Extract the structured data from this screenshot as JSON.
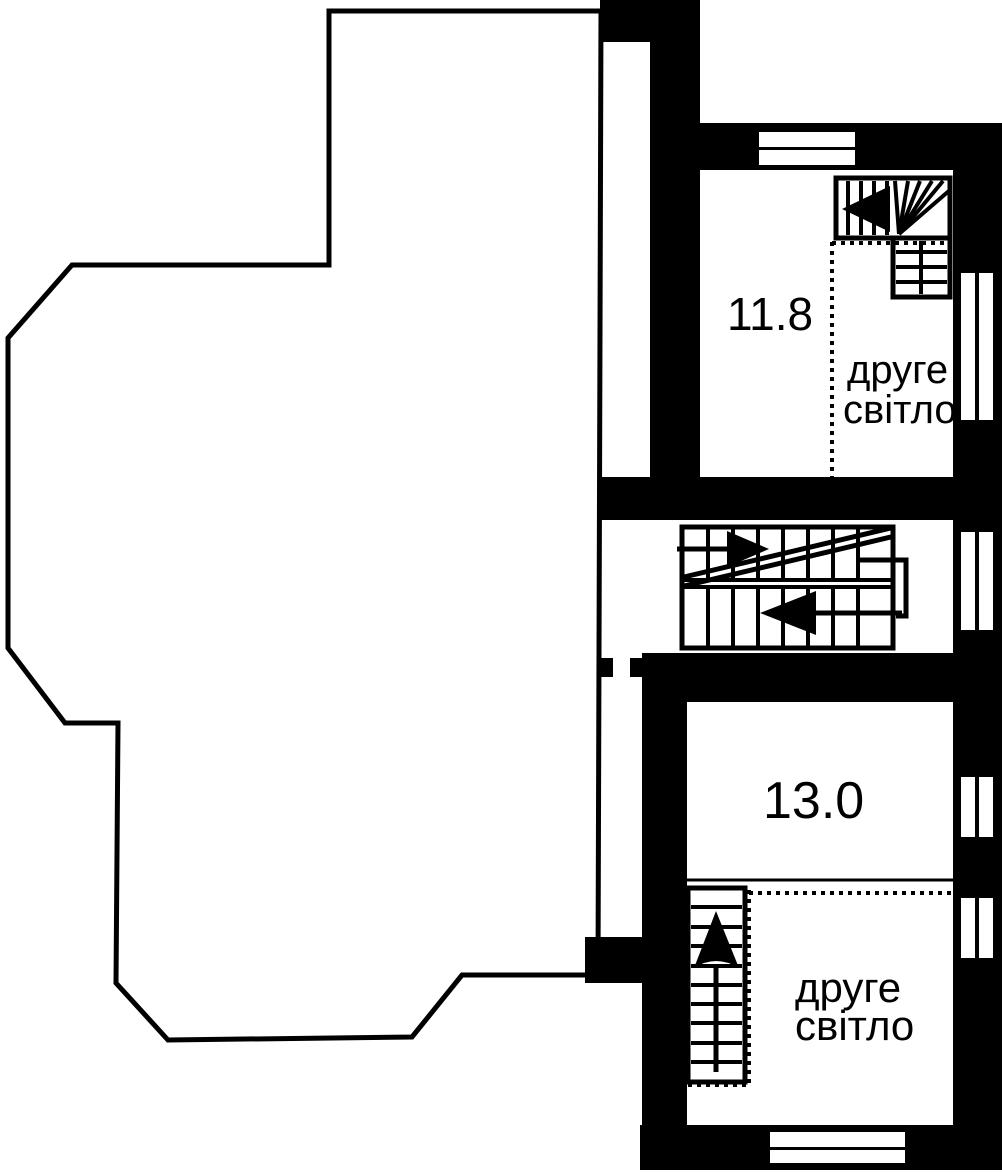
{
  "page": {
    "type": "apartment floor plan",
    "language": "uk"
  },
  "colors": {
    "wall": "#000000",
    "background": "#ffffff",
    "text": "#000000"
  },
  "rooms": {
    "upper": {
      "area": "11.8",
      "void_line1": "друге",
      "void_line2": "світло"
    },
    "lower": {
      "area": "13.0",
      "void_line1": "друге",
      "void_line2": "світло"
    }
  },
  "icons": {
    "winder_stair_arrow": "◀",
    "mid_stair_upper_arrow": "▶",
    "mid_stair_lower_arrow": "◀",
    "bottom_stair_arrow": "▲"
  }
}
